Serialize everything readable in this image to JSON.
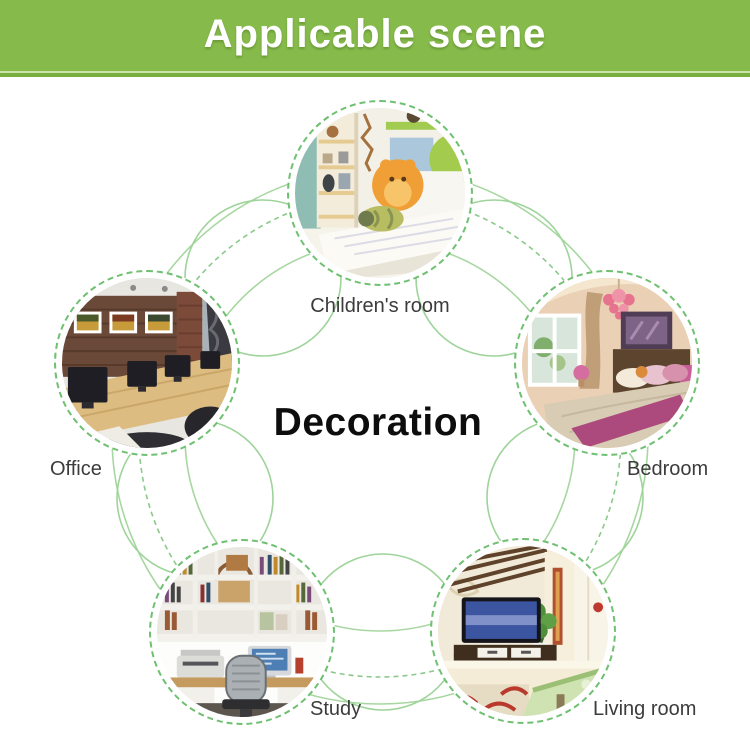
{
  "banner": {
    "title": "Applicable scene"
  },
  "center": {
    "title": "Decoration"
  },
  "scenes": [
    {
      "id": "childrens-room",
      "label": "Children's room"
    },
    {
      "id": "office",
      "label": "Office"
    },
    {
      "id": "bedroom",
      "label": "Bedroom"
    },
    {
      "id": "study",
      "label": "Study"
    },
    {
      "id": "living-room",
      "label": "Living room"
    }
  ],
  "colors": {
    "banner_green": "#86bb4b",
    "banner_stripe_light": "#cde3ac",
    "banner_stripe_dark": "#79af41",
    "ring_dash_green": "#6fc071",
    "arc_green": "#a7d7a0",
    "orbit_dash_green": "#8cc98c",
    "label_text": "#3c3c3c",
    "center_text": "#0d0d0d"
  }
}
